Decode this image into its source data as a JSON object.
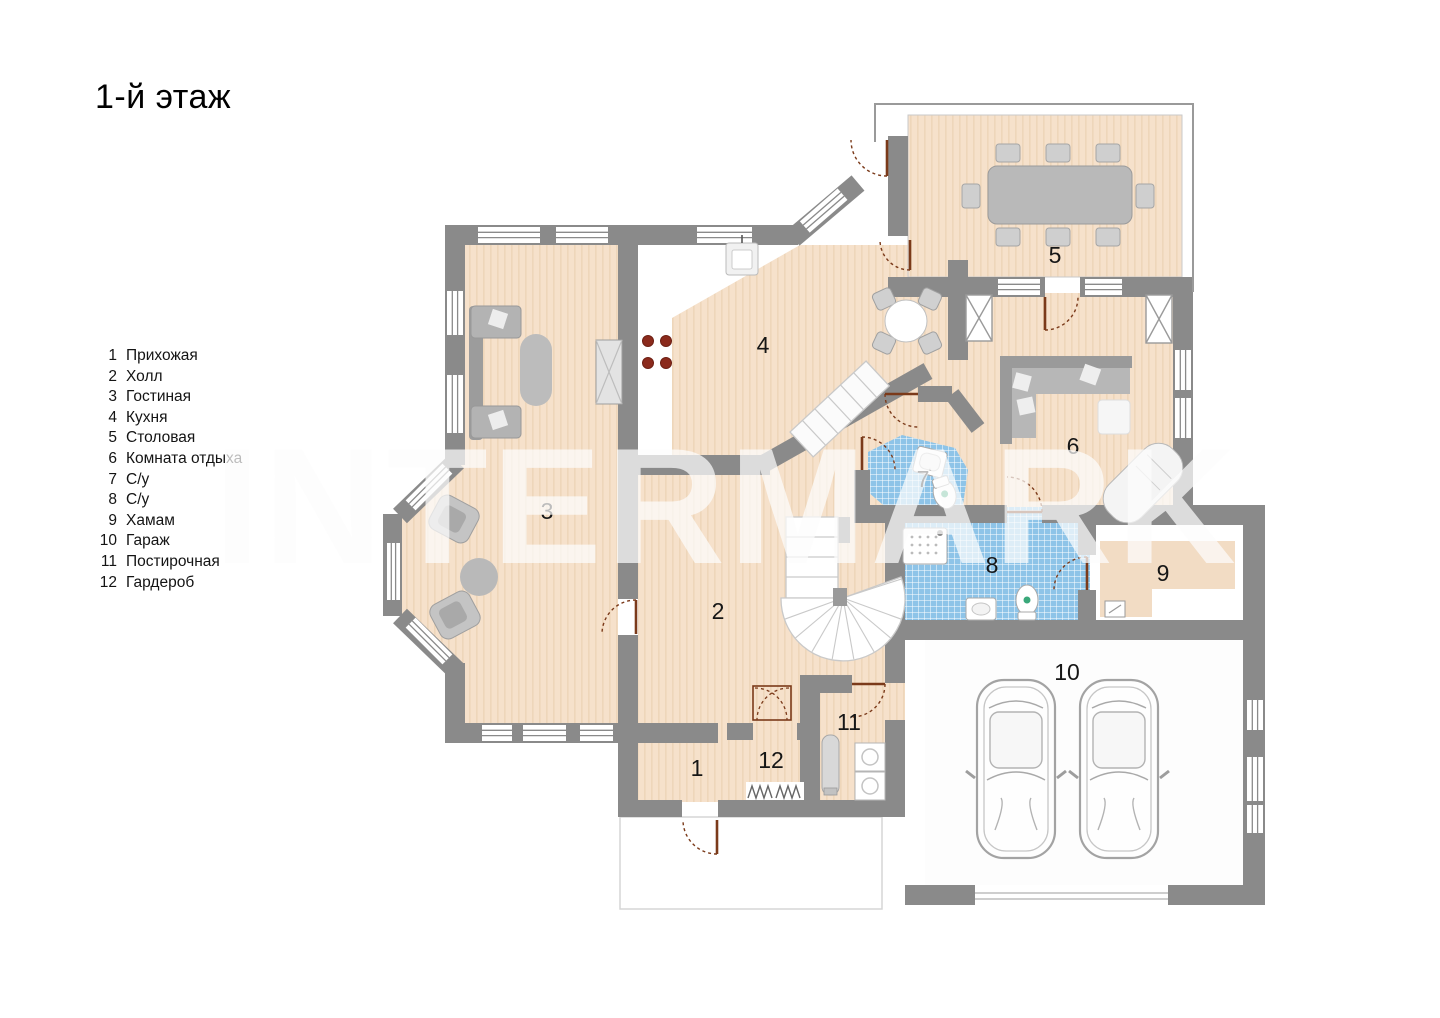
{
  "page": {
    "title": "1-й этаж",
    "background": "#ffffff"
  },
  "watermark": {
    "text": "INTERMARK"
  },
  "legend": {
    "items": [
      {
        "number": "1",
        "label": "Прихожая"
      },
      {
        "number": "2",
        "label": "Холл"
      },
      {
        "number": "3",
        "label": "Гостиная"
      },
      {
        "number": "4",
        "label": "Кухня"
      },
      {
        "number": "5",
        "label": "Столовая"
      },
      {
        "number": "6",
        "label": "Комната отдыха"
      },
      {
        "number": "7",
        "label": "С/у"
      },
      {
        "number": "8",
        "label": "С/у"
      },
      {
        "number": "9",
        "label": "Хамам"
      },
      {
        "number": "10",
        "label": "Гараж"
      },
      {
        "number": "11",
        "label": "Постирочная"
      },
      {
        "number": "12",
        "label": "Гардероб"
      }
    ]
  },
  "plan": {
    "rooms": [
      {
        "number": "1",
        "name": "Прихожая"
      },
      {
        "number": "2",
        "name": "Холл"
      },
      {
        "number": "3",
        "name": "Гостиная"
      },
      {
        "number": "4",
        "name": "Кухня"
      },
      {
        "number": "5",
        "name": "Столовая"
      },
      {
        "number": "6",
        "name": "Комната отдыха"
      },
      {
        "number": "7",
        "name": "С/у"
      },
      {
        "number": "8",
        "name": "С/у"
      },
      {
        "number": "9",
        "name": "Хамам"
      },
      {
        "number": "10",
        "name": "Гараж"
      },
      {
        "number": "11",
        "name": "Постирочная"
      },
      {
        "number": "12",
        "name": "Гардероб"
      }
    ],
    "colors": {
      "wall": "#8a8a8a",
      "floor": "#f6e1cb",
      "floor_stripe": "#eed6ba",
      "wet_floor": "#8ec4e8",
      "door": "#7b3a1a",
      "furniture": "#b9b9b9"
    }
  }
}
